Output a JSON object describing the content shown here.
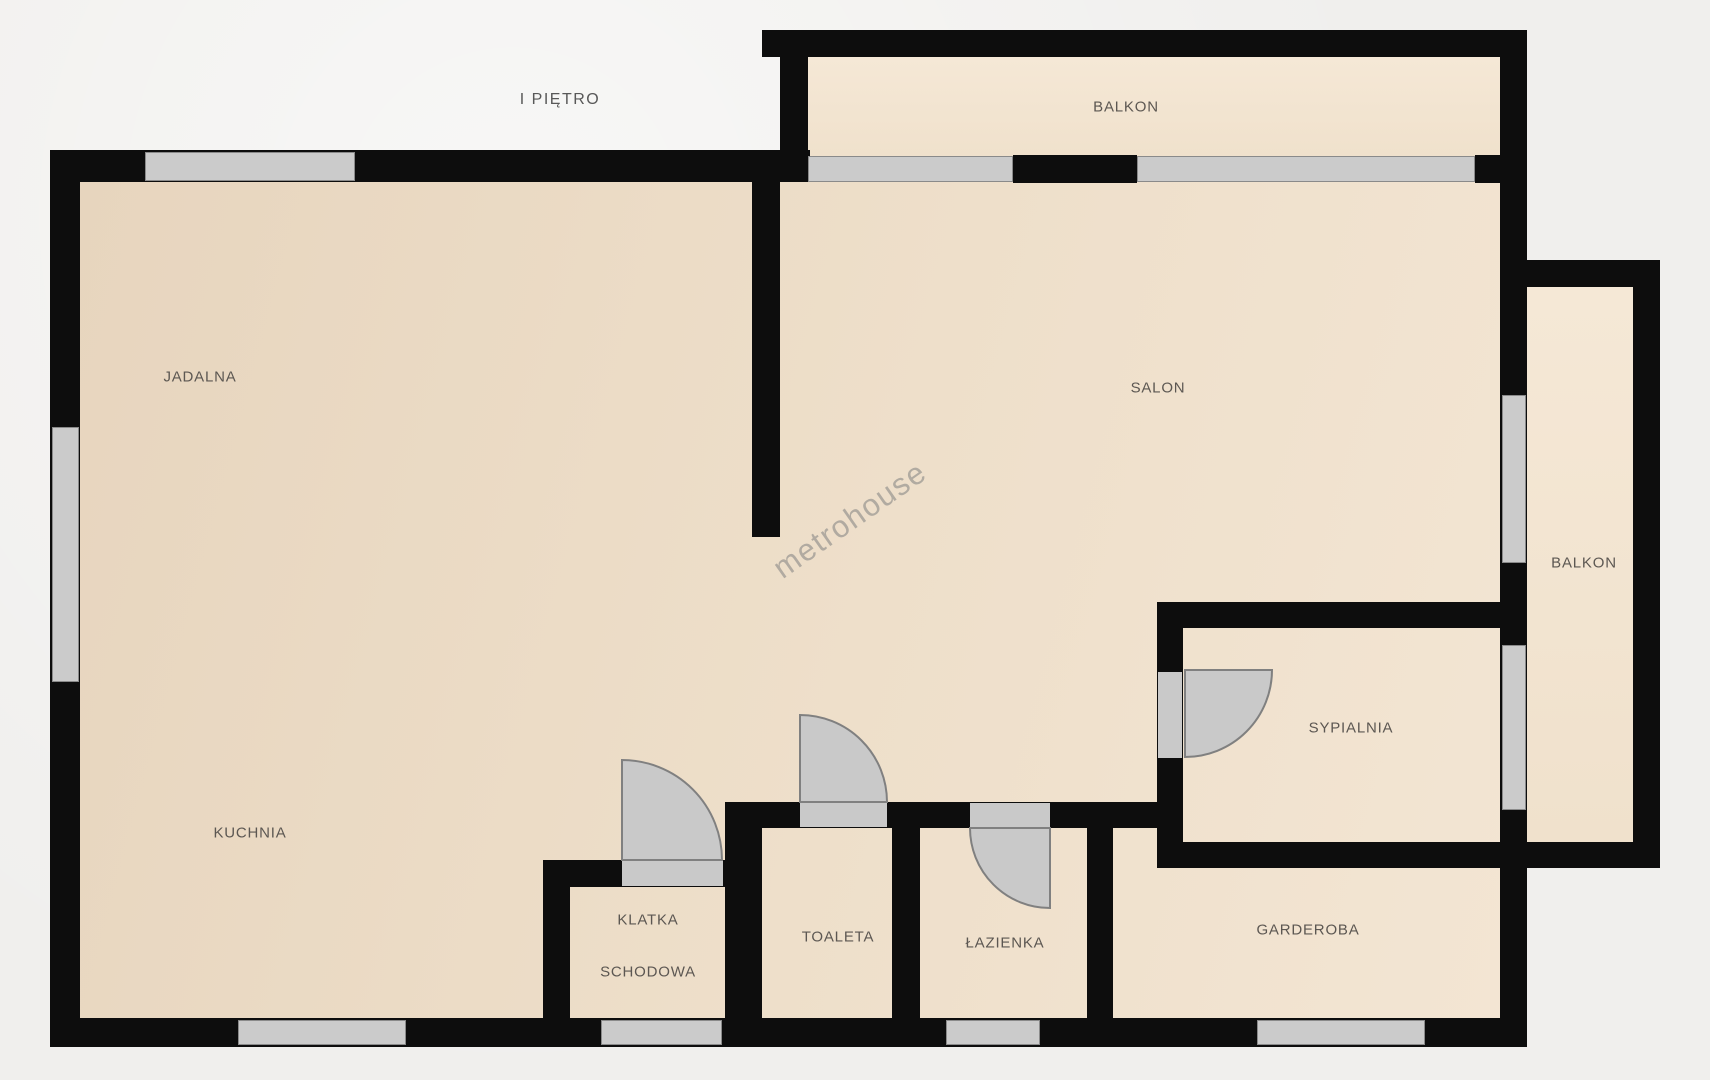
{
  "plan": {
    "floor_title": "I PIĘTRO",
    "watermark": "metrohouse",
    "rooms": {
      "jadalna": "JADALNA",
      "kuchnia": "KUCHNIA",
      "salon": "SALON",
      "balkon_top": "BALKON",
      "balkon_right": "BALKON",
      "sypialnia": "SYPIALNIA",
      "garderoba": "GARDEROBA",
      "klatka_line1": "KLATKA",
      "klatka_line2": "SCHODOWA",
      "toaleta": "TOALETA",
      "lazienka": "ŁAZIENKA"
    },
    "colors": {
      "wall": "#0d0d0d",
      "window": "#cbcbcb",
      "window_border": "#8a8a8a",
      "door": "#c9c9c9",
      "door_stroke": "#808080",
      "outside": "#f0efed",
      "label": "#5c5752",
      "floor_dark": "#e7d5be",
      "floor_light": "#f3e5d3",
      "balcony_floor": "#f5e8d6",
      "title_color": "#585858"
    }
  }
}
